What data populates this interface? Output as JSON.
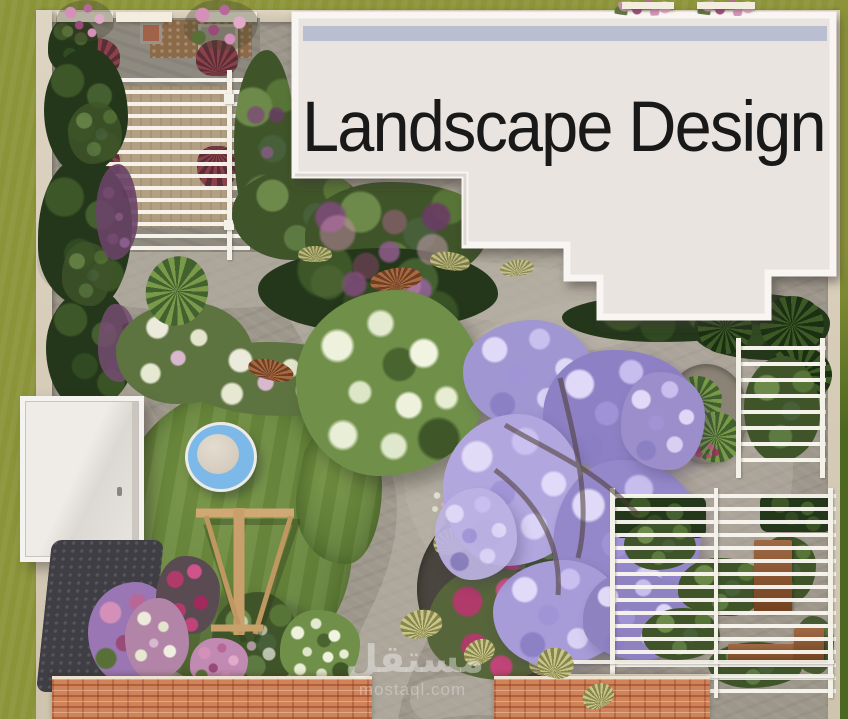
{
  "title": {
    "text": "Landscape Design"
  },
  "watermark": {
    "site_name_arabic": "مستقل",
    "site_domain": "mostaql.com"
  },
  "palette": {
    "outer_lawn": "#8b9438",
    "outer_lawn_dark": "#4c671f",
    "wall": "#ded4c2",
    "building_roof": "#e9e4df",
    "building_frame": "#f8f5f2",
    "skylight": "#b4bbcf",
    "stone_path": "#9d968b",
    "lawn_green": "#63823a",
    "foliage_dark": "#24371b",
    "foliage_mid": "#3f5429",
    "jacaranda_light": "#b1a6de",
    "jacaranda_deep": "#8d80c4",
    "flower_magenta": "#b03a6a",
    "flower_lilac": "#9a76b4",
    "trampoline_blue": "#7db9e8",
    "trampoline_mat": "#d5ccbe",
    "deck_wood": "#b3a083",
    "frame_wood": "#cfa873",
    "bench_wood": "#8f5126",
    "roof_tile": "#d08258",
    "gravel_dark": "#3e3e44",
    "title_color": "#191919"
  }
}
